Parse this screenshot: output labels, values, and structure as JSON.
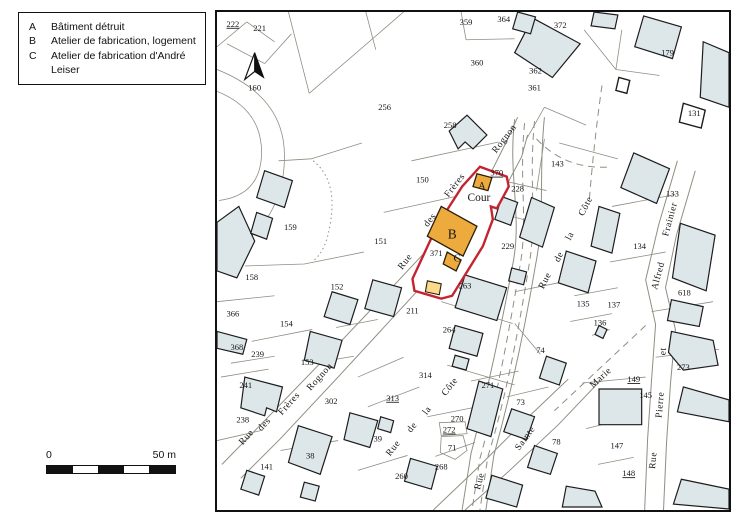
{
  "legend": {
    "items": [
      {
        "key": "A",
        "label": "Bâtiment détruit"
      },
      {
        "key": "B",
        "label": "Atelier de fabrication, logement"
      },
      {
        "key": "C",
        "label": "Atelier de fabrication d'André Leiser"
      }
    ]
  },
  "scalebar": {
    "left_label": "0",
    "right_label": "50 m"
  },
  "icons": {
    "north_arrow": "north-arrow"
  },
  "colors": {
    "building_fill": "#dde6e8",
    "building_stroke": "#1c1c1c",
    "parcel_line": "#8e8e82",
    "highlight": "#c32430",
    "atelier_fill": "#eeab3d",
    "annex_fill": "#fbd98d",
    "frame": "#111111"
  },
  "map": {
    "parcel_numbers": [
      {
        "t": "222",
        "x": 16,
        "y": 13,
        "u": true
      },
      {
        "t": "221",
        "x": 43,
        "y": 17
      },
      {
        "t": "359",
        "x": 251,
        "y": 11
      },
      {
        "t": "364",
        "x": 289,
        "y": 8
      },
      {
        "t": "372",
        "x": 346,
        "y": 14
      },
      {
        "t": "360",
        "x": 262,
        "y": 52
      },
      {
        "t": "362",
        "x": 321,
        "y": 60
      },
      {
        "t": "361",
        "x": 320,
        "y": 77
      },
      {
        "t": "179",
        "x": 454,
        "y": 42
      },
      {
        "t": "131",
        "x": 481,
        "y": 103
      },
      {
        "t": "160",
        "x": 38,
        "y": 77
      },
      {
        "t": "256",
        "x": 169,
        "y": 97
      },
      {
        "t": "258",
        "x": 235,
        "y": 115
      },
      {
        "t": "150",
        "x": 207,
        "y": 170
      },
      {
        "t": "143",
        "x": 343,
        "y": 154
      },
      {
        "t": "370",
        "x": 282,
        "y": 163,
        "u": true
      },
      {
        "t": "228",
        "x": 303,
        "y": 179
      },
      {
        "t": "229",
        "x": 293,
        "y": 237
      },
      {
        "t": "371",
        "x": 221,
        "y": 244
      },
      {
        "t": "263",
        "x": 250,
        "y": 277
      },
      {
        "t": "211",
        "x": 197,
        "y": 302
      },
      {
        "t": "264",
        "x": 234,
        "y": 321
      },
      {
        "t": "314",
        "x": 210,
        "y": 367
      },
      {
        "t": "74",
        "x": 326,
        "y": 342
      },
      {
        "t": "135",
        "x": 369,
        "y": 295
      },
      {
        "t": "137",
        "x": 400,
        "y": 296
      },
      {
        "t": "136",
        "x": 386,
        "y": 314
      },
      {
        "t": "618",
        "x": 471,
        "y": 284
      },
      {
        "t": "273",
        "x": 470,
        "y": 359
      },
      {
        "t": "149",
        "x": 420,
        "y": 371,
        "u": true
      },
      {
        "t": "145",
        "x": 432,
        "y": 387
      },
      {
        "t": "147",
        "x": 403,
        "y": 438
      },
      {
        "t": "148",
        "x": 415,
        "y": 466,
        "u": true
      },
      {
        "t": "133",
        "x": 459,
        "y": 184
      },
      {
        "t": "134",
        "x": 426,
        "y": 237
      },
      {
        "t": "159",
        "x": 74,
        "y": 218
      },
      {
        "t": "151",
        "x": 165,
        "y": 232
      },
      {
        "t": "158",
        "x": 35,
        "y": 268
      },
      {
        "t": "152",
        "x": 121,
        "y": 278
      },
      {
        "t": "366",
        "x": 16,
        "y": 305
      },
      {
        "t": "154",
        "x": 70,
        "y": 315
      },
      {
        "t": "368",
        "x": 20,
        "y": 339
      },
      {
        "t": "239",
        "x": 41,
        "y": 346
      },
      {
        "t": "241",
        "x": 29,
        "y": 377
      },
      {
        "t": "238",
        "x": 26,
        "y": 412
      },
      {
        "t": "153",
        "x": 91,
        "y": 354
      },
      {
        "t": "302",
        "x": 115,
        "y": 393
      },
      {
        "t": "38",
        "x": 94,
        "y": 448
      },
      {
        "t": "141",
        "x": 50,
        "y": 459
      },
      {
        "t": "39",
        "x": 162,
        "y": 431
      },
      {
        "t": "313",
        "x": 177,
        "y": 390,
        "u": true
      },
      {
        "t": "270",
        "x": 242,
        "y": 411
      },
      {
        "t": "272",
        "x": 234,
        "y": 422,
        "u": true
      },
      {
        "t": "71",
        "x": 237,
        "y": 440
      },
      {
        "t": "271",
        "x": 273,
        "y": 377
      },
      {
        "t": "73",
        "x": 306,
        "y": 394
      },
      {
        "t": "268",
        "x": 226,
        "y": 459
      },
      {
        "t": "260",
        "x": 186,
        "y": 469
      },
      {
        "t": "78",
        "x": 342,
        "y": 434
      }
    ],
    "building_letters": [
      {
        "t": "A",
        "x": 267,
        "y": 176,
        "s": 9.5
      },
      {
        "t": "B",
        "x": 237,
        "y": 225,
        "s": 13.5
      },
      {
        "t": "C",
        "x": 242,
        "y": 249,
        "s": 11
      },
      {
        "t": "Cour",
        "x": 264,
        "y": 188,
        "s": 11.5
      }
    ],
    "street_names": [
      {
        "t": "Rognon",
        "x": 290,
        "y": 128,
        "r": -52
      },
      {
        "t": "Frères",
        "x": 240,
        "y": 175,
        "r": -52
      },
      {
        "t": "des",
        "x": 215,
        "y": 210,
        "r": -52
      },
      {
        "t": "Rue",
        "x": 190,
        "y": 252,
        "r": -52
      },
      {
        "t": "Rognon",
        "x": 104,
        "y": 368,
        "r": -48
      },
      {
        "t": "Frères",
        "x": 73,
        "y": 395,
        "r": -48
      },
      {
        "t": "des",
        "x": 48,
        "y": 416,
        "r": -48
      },
      {
        "t": "Rue",
        "x": 30,
        "y": 429,
        "r": -48
      },
      {
        "t": "Côte",
        "x": 372,
        "y": 196,
        "r": -63
      },
      {
        "t": "la",
        "x": 356,
        "y": 226,
        "r": -63
      },
      {
        "t": "de",
        "x": 345,
        "y": 247,
        "r": -63
      },
      {
        "t": "Rue",
        "x": 331,
        "y": 271,
        "r": -63
      },
      {
        "t": "Côte",
        "x": 235,
        "y": 378,
        "r": -52
      },
      {
        "t": "la",
        "x": 212,
        "y": 402,
        "r": -52
      },
      {
        "t": "de",
        "x": 197,
        "y": 419,
        "r": -52
      },
      {
        "t": "Rue",
        "x": 178,
        "y": 440,
        "r": -52
      },
      {
        "t": "Sainte",
        "x": 311,
        "y": 430,
        "r": -54
      },
      {
        "t": "Rue",
        "x": 265,
        "y": 473,
        "r": -75
      },
      {
        "t": "Frainier",
        "x": 457,
        "y": 209,
        "r": -75
      },
      {
        "t": "Alfred",
        "x": 445,
        "y": 266,
        "r": -75
      },
      {
        "t": "Marie",
        "x": 387,
        "y": 369,
        "r": -43
      },
      {
        "t": "et",
        "x": 450,
        "y": 342,
        "r": -85
      },
      {
        "t": "Pierre",
        "x": 447,
        "y": 396,
        "r": -85
      },
      {
        "t": "Rue",
        "x": 440,
        "y": 452,
        "r": -85
      }
    ]
  }
}
